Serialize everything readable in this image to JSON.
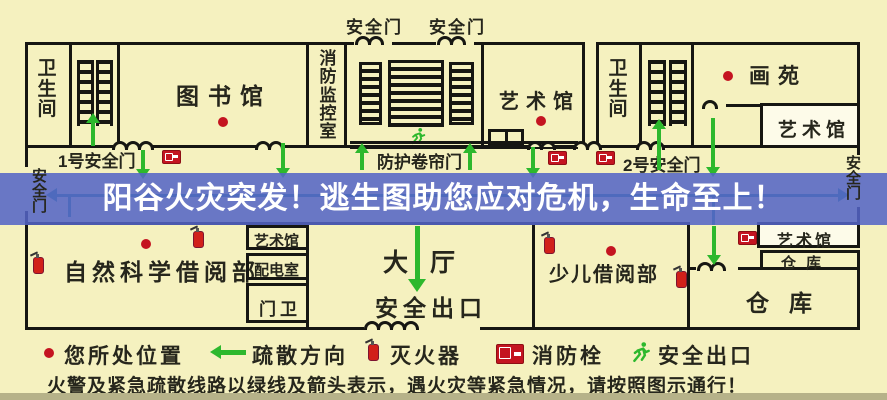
{
  "banner": {
    "text": "阳谷火灾突发！逃生图助您应对危机，生命至上！"
  },
  "rooms": {
    "wc_left": "卫生间",
    "library": "图书馆",
    "fire_monitor": "消防监控室",
    "art_top": "艺术馆",
    "wc_right": "卫生间",
    "huayuan": "画苑",
    "art_top_right": "艺术馆",
    "science_reading": "自然科学借阅部",
    "art_mid": "艺术馆",
    "power_room": "配电室",
    "gate_guard": "门卫",
    "hall": "大厅",
    "hall_exit": "安全出口",
    "children_reading": "少儿借阅部",
    "art_bottom_right": "艺术馆",
    "warehouse_small": "仓库",
    "warehouse_big": "仓库"
  },
  "doors": {
    "top_door_1": "安全门",
    "top_door_2": "安全门",
    "gate_1": "1号安全门",
    "gate_2": "2号安全门",
    "shutter": "防护卷帘门",
    "west_exit": "安全门",
    "east_exit": "安全门"
  },
  "legend": {
    "items": [
      {
        "icon": "location-dot",
        "label": "您所处位置"
      },
      {
        "icon": "evacuation-arrow",
        "label": "疏散方向"
      },
      {
        "icon": "fire-extinguisher",
        "label": "灭火器"
      },
      {
        "icon": "fire-hydrant",
        "label": "消防栓"
      },
      {
        "icon": "running-man",
        "label": "安全出口"
      }
    ],
    "note": "火警及紧急疏散线路以绿线及箭头表示，遇火灾等紧急情况，请按照图示通行！"
  },
  "colors": {
    "background": "#f5f1bf",
    "wall": "#161612",
    "banner_blue": "#5464c5",
    "arrow_green": "#2db82d",
    "guide_teal": "#2a9284",
    "marker_red": "#c41420"
  }
}
